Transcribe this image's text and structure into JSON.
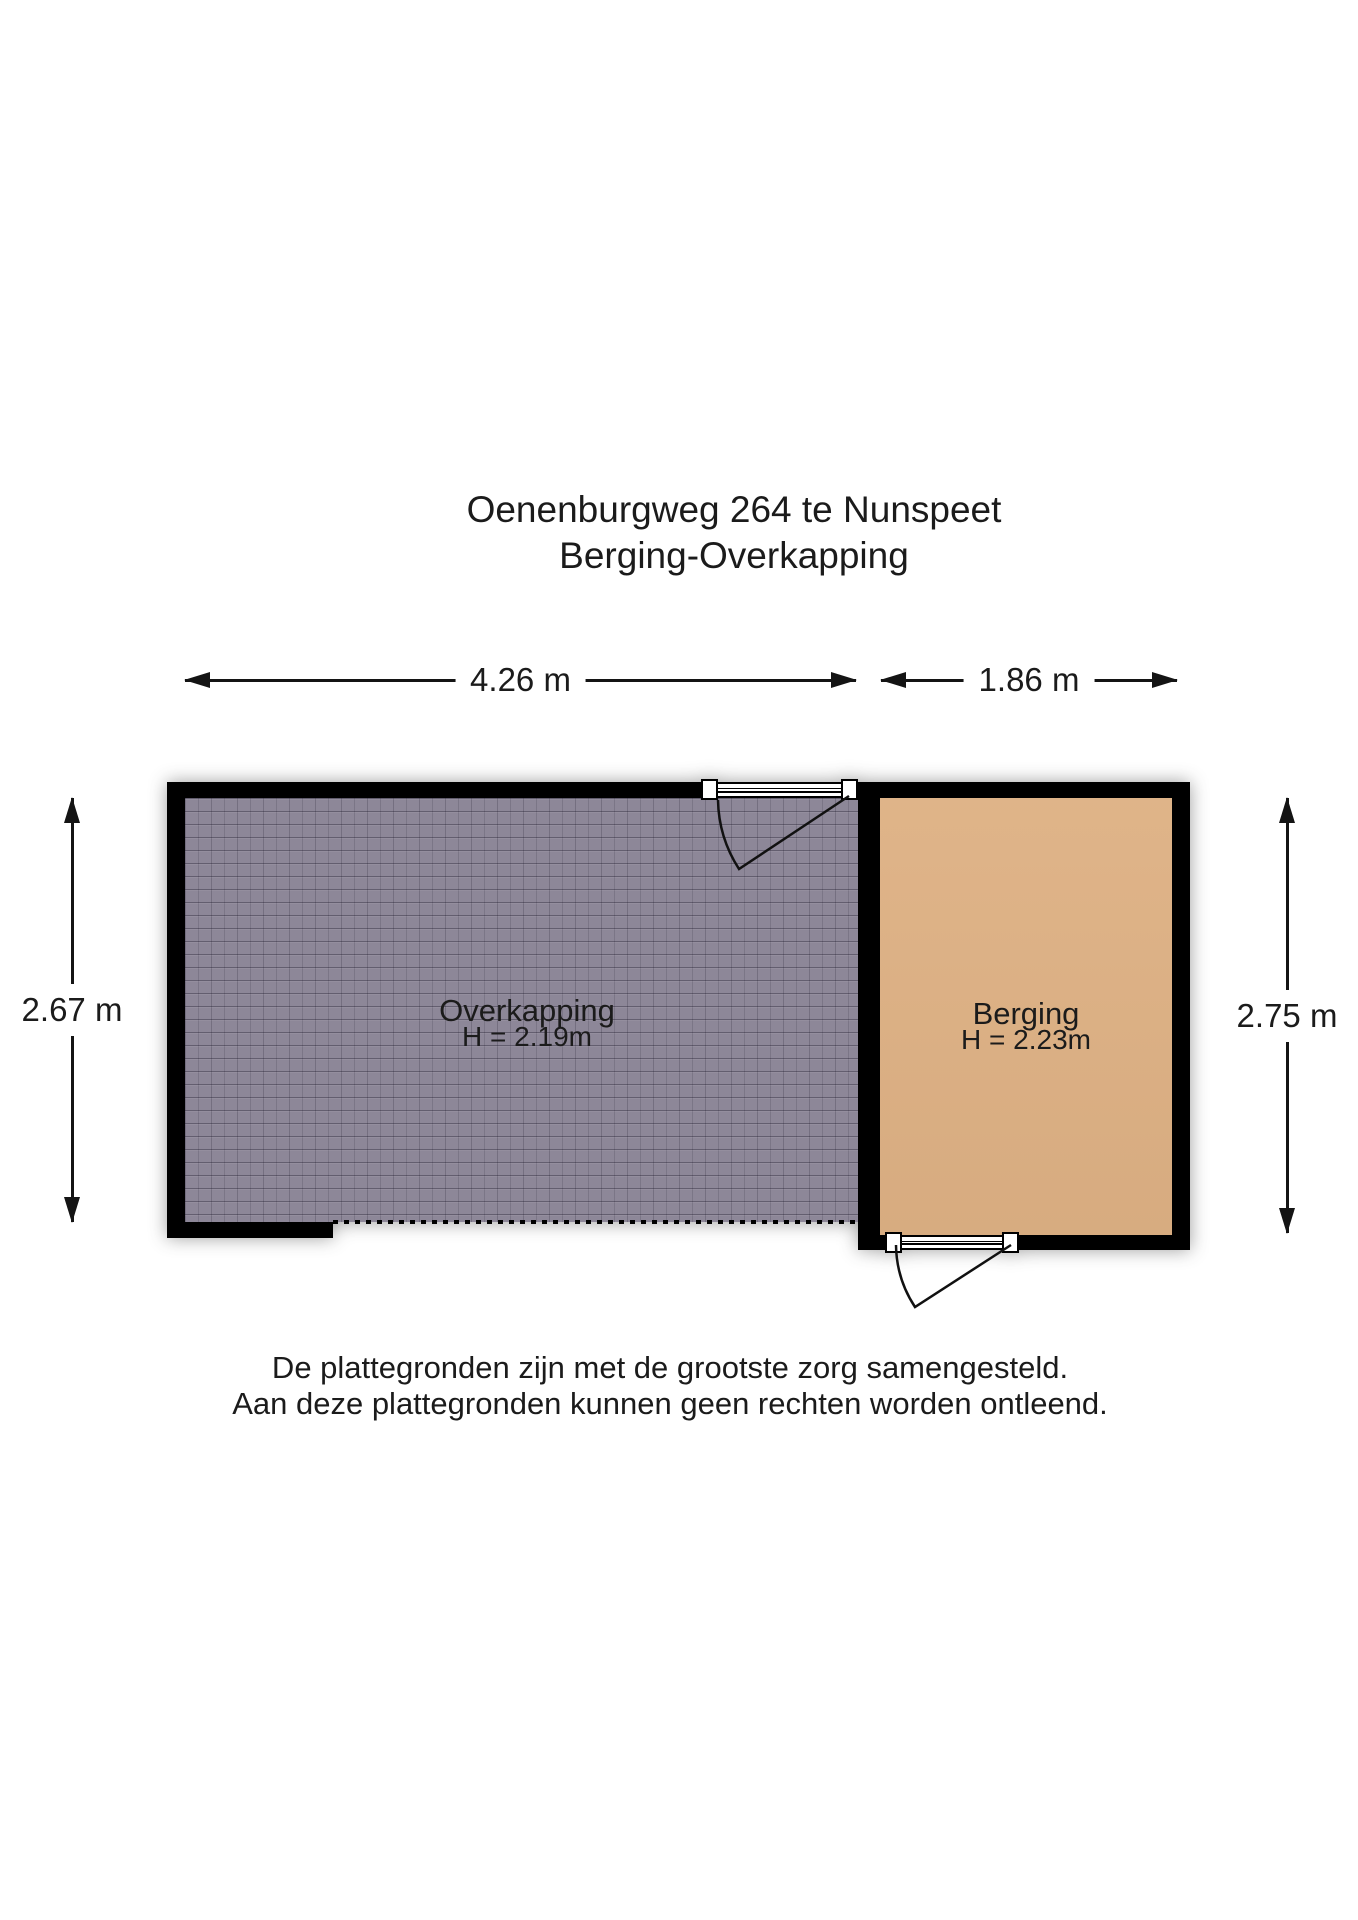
{
  "title": {
    "line1": "Oenenburgweg 264 te Nunspeet",
    "line2": "Berging-Overkapping"
  },
  "dimensions": {
    "top_left": {
      "label": "4.26 m"
    },
    "top_right": {
      "label": "1.86 m"
    },
    "left": {
      "label": "2.67 m"
    },
    "right": {
      "label": "2.75 m"
    }
  },
  "rooms": [
    {
      "name": "Overkapping",
      "height_label": "H = 2.19m",
      "floor_color": "#8d8798"
    },
    {
      "name": "Berging",
      "height_label": "H = 2.23m",
      "floor_color": "#deb184"
    }
  ],
  "disclaimer": {
    "line1": "De plattegronden zijn met de grootste zorg samengesteld.",
    "line2": "Aan deze plattegronden kunnen geen rechten worden ontleend."
  },
  "colors": {
    "wall": "#000000",
    "overkapping_floor": "#8d8798",
    "berging_floor": "#deb184",
    "text": "#1b1b1b"
  }
}
